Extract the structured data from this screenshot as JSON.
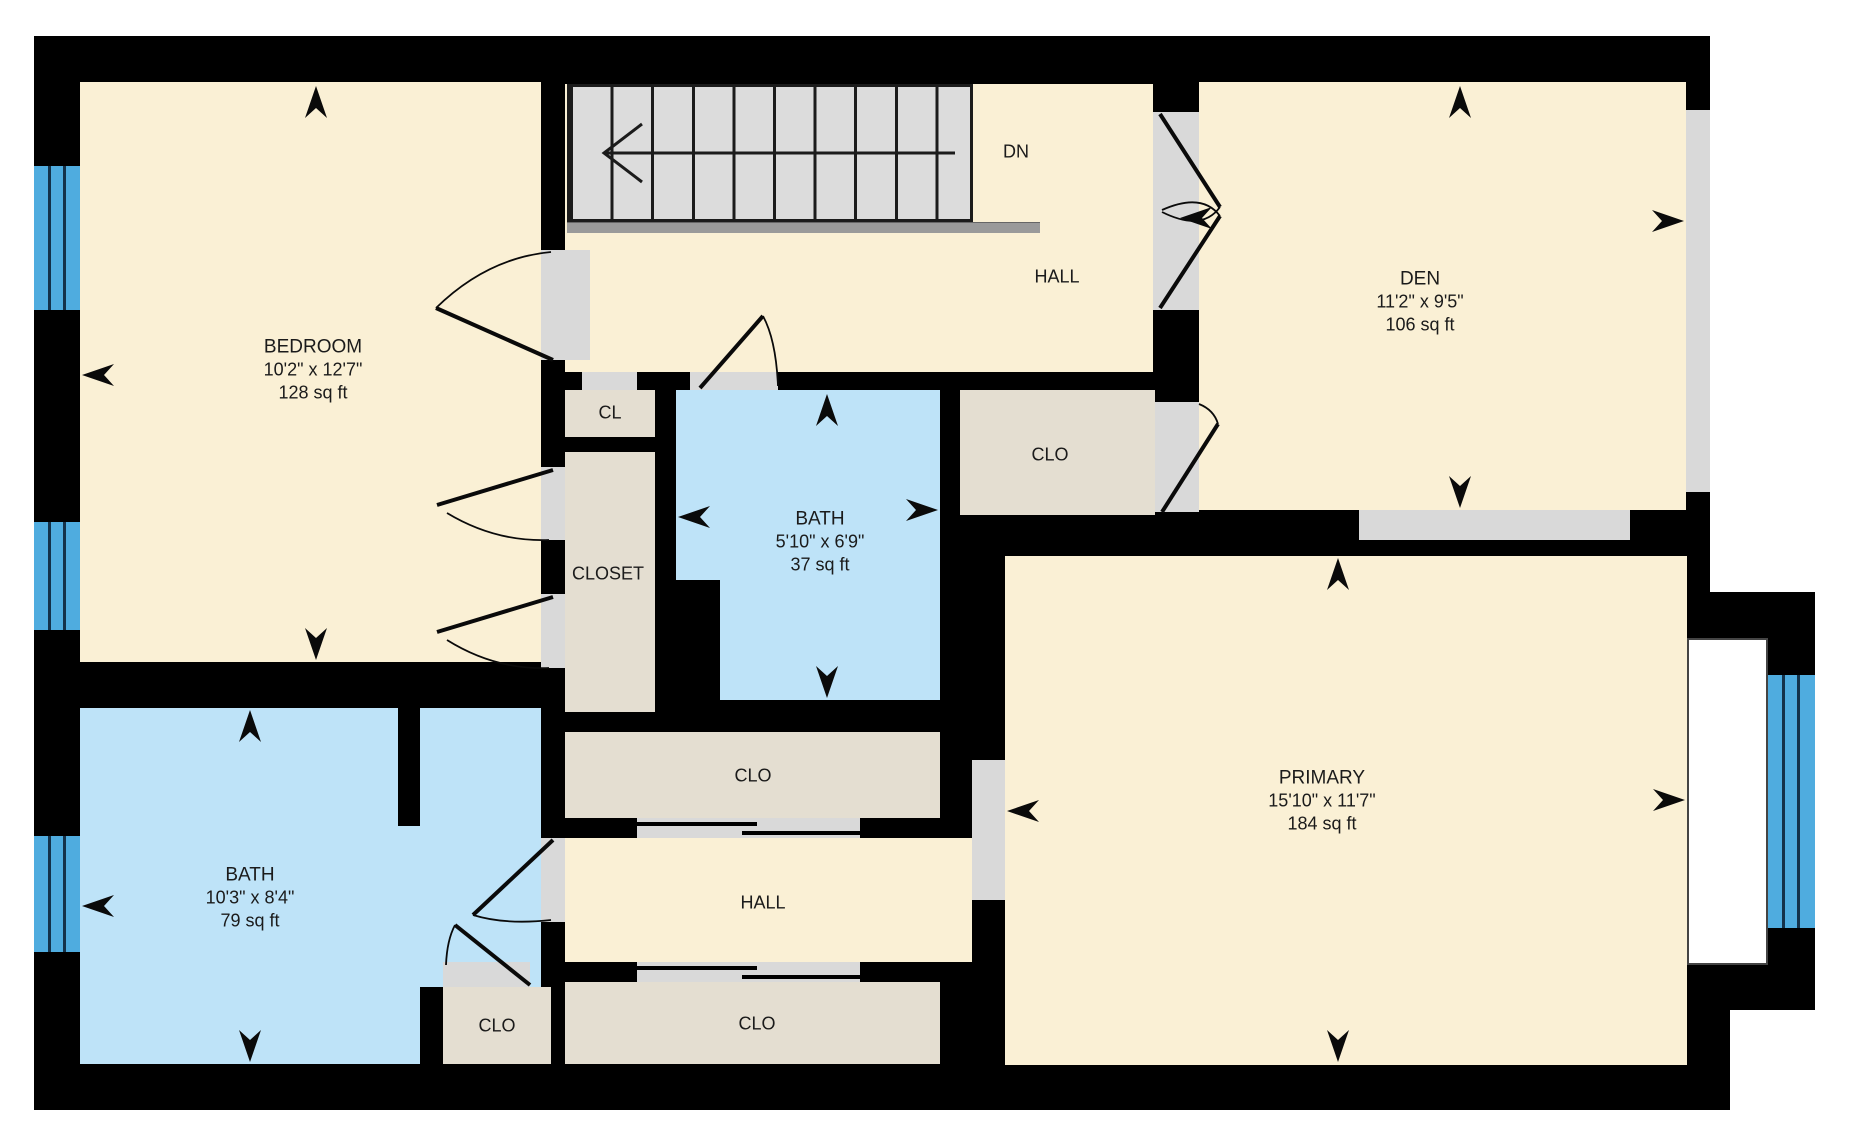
{
  "rooms": {
    "bedroom": {
      "name": "BEDROOM",
      "dims": "10'2\" x 12'7\"",
      "area": "128 sq ft"
    },
    "bath_lower": {
      "name": "BATH",
      "dims": "10'3\" x 8'4\"",
      "area": "79 sq ft"
    },
    "bath_center": {
      "name": "BATH",
      "dims": "5'10\" x 6'9\"",
      "area": "37 sq ft"
    },
    "den": {
      "name": "DEN",
      "dims": "11'2\" x 9'5\"",
      "area": "106 sq ft"
    },
    "primary": {
      "name": "PRIMARY",
      "dims": "15'10\" x 11'7\"",
      "area": "184 sq ft"
    },
    "hall_upper": {
      "name": "HALL"
    },
    "hall_lower": {
      "name": "HALL"
    }
  },
  "closets": {
    "cl": {
      "name": "CL"
    },
    "closet": {
      "name": "CLOSET"
    },
    "clo_den": {
      "name": "CLO"
    },
    "clo_upper": {
      "name": "CLO"
    },
    "clo_lower": {
      "name": "CLO"
    },
    "clo_small": {
      "name": "CLO"
    }
  },
  "stairs": {
    "direction_label": "DN"
  },
  "colors": {
    "wall": "#000000",
    "room_cream": "#FAF0D5",
    "closet_tan": "#E4DED1",
    "bath_blue": "#BEE3F8",
    "window_blue": "#4FACDF",
    "opening_gray": "#D9D9D9",
    "stair_gray": "#DCDCDC",
    "text": "#1B1B1B",
    "outside": "#FFFFFF"
  }
}
